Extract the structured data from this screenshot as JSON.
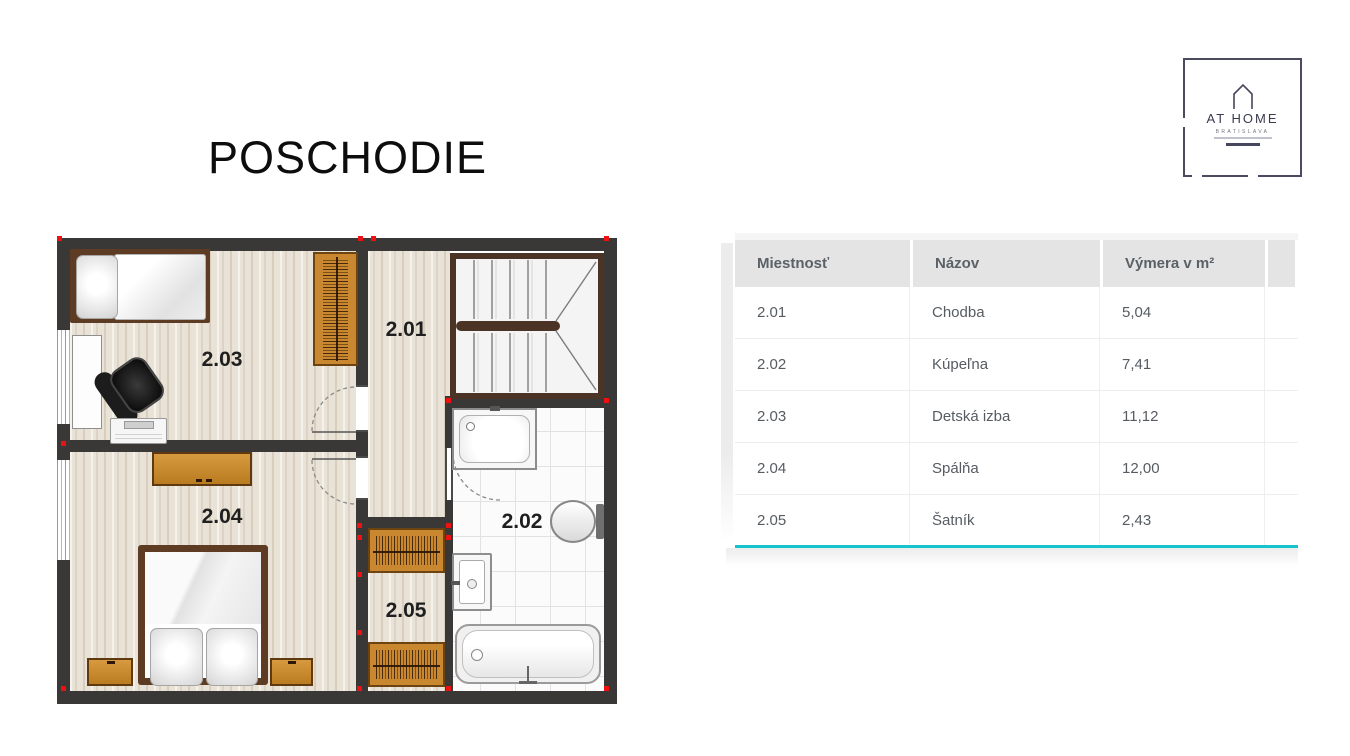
{
  "slide": {
    "title": "POSCHODIE"
  },
  "logo": {
    "name": "AT HOME",
    "city": "BRATISLAVA"
  },
  "floor_plan": {
    "labels": {
      "r201": "2.01",
      "r202": "2.02",
      "r203": "2.03",
      "r204": "2.04",
      "r205": "2.05"
    }
  },
  "table": {
    "headers": [
      "Miestnosť",
      "Názov",
      "Výmera v m²"
    ],
    "rows": [
      {
        "id": "2.01",
        "name": "Chodba",
        "area": "5,04"
      },
      {
        "id": "2.02",
        "name": "Kúpeľna",
        "area": "7,41"
      },
      {
        "id": "2.03",
        "name": "Detská izba",
        "area": "11,12"
      },
      {
        "id": "2.04",
        "name": "Spálňa",
        "area": "12,00"
      },
      {
        "id": "2.05",
        "name": "Šatník",
        "area": "2,43"
      }
    ],
    "accent_color": "#17c3cd",
    "header_bg": "#e4e4e4"
  },
  "colors": {
    "wall": "#3a3837",
    "furniture_orange": "#c9882f"
  }
}
